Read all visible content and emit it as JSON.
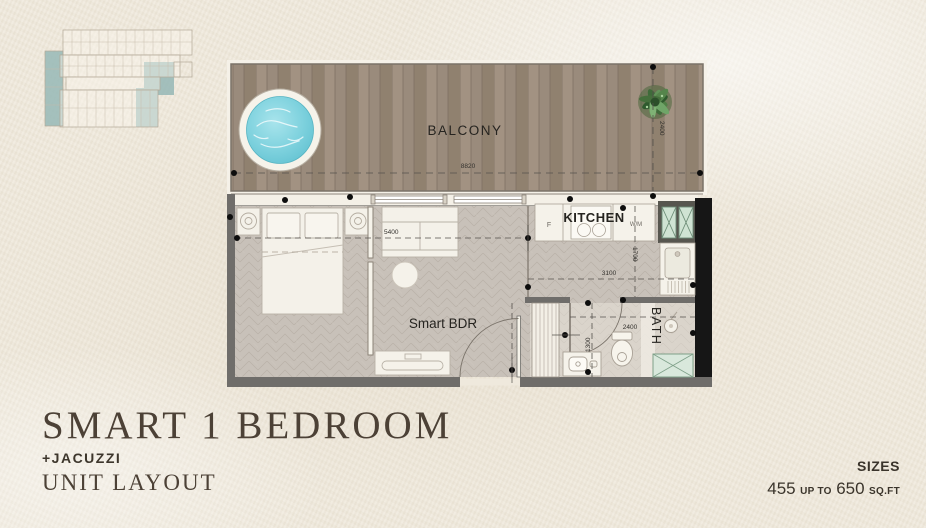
{
  "page": {
    "title_line1": "SMART 1 BEDROOM",
    "title_line2": "+JACUZZI",
    "title_line3": "UNIT LAYOUT"
  },
  "sizes": {
    "label": "SIZES",
    "from": "455",
    "connector": "UP TO",
    "to": "650",
    "unit": "SQ.FT"
  },
  "plan": {
    "rooms": {
      "balcony": "BALCONY",
      "kitchen": "KITCHEN",
      "bedroom": "Smart BDR",
      "bath": "BATH"
    },
    "appliances": {
      "fridge": "F",
      "washing_machine": "W/M"
    },
    "dimensions": {
      "balcony_width": "8820",
      "balcony_depth": "2400",
      "sofa_wall": "5400",
      "kitchen_depth": "1700",
      "kitchen_width": "3100",
      "bath_width": "2400",
      "bath_depth": "1300"
    }
  },
  "colors": {
    "background": "#efe9dc",
    "title": "#4c4136",
    "keyplan_highlight": "#96b8b6",
    "balcony_wood": "#9a8b7c",
    "jacuzzi_water": "#7fd2de",
    "wall_gray": "#6f6d6a",
    "wall_black": "#161616",
    "floor": "#c8c1b9",
    "hatch_green": "#7fa089"
  }
}
